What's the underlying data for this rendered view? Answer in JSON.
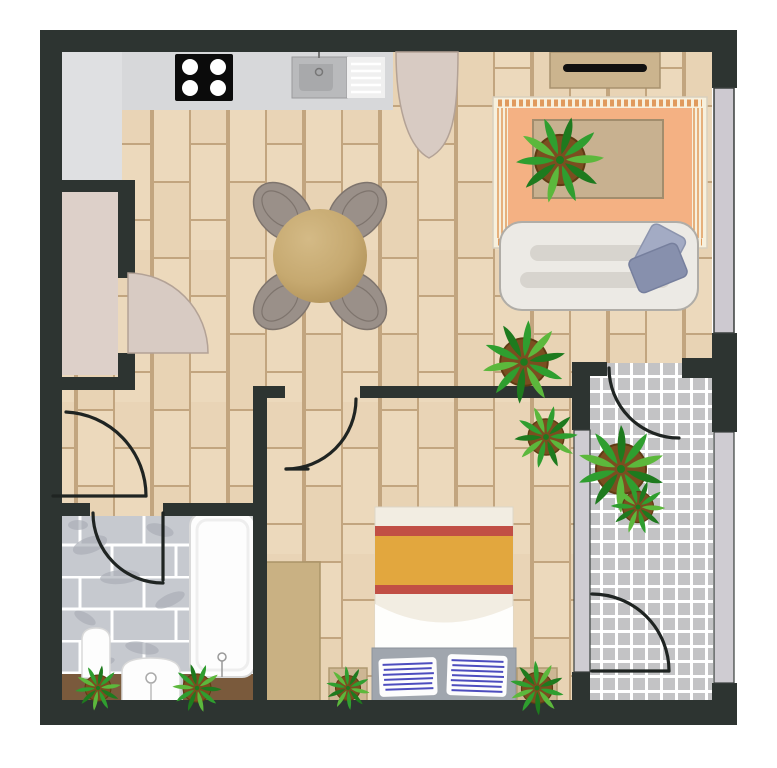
{
  "title": "Apartment floor plan (top-down view)",
  "colors": {
    "wall": "#2d3431",
    "doorLine": "#1f2422",
    "woodBase": "#ecd9bc",
    "woodAlt": "#e2ccab",
    "woodLine": "#c2a57f",
    "counterStrip": "#d7d8da",
    "kitchenFloor": "#dfe0e2",
    "nookFloor": "#ddd0c9",
    "doorFill": "#d8cbc3",
    "doorEdge": "#b3a296",
    "stove": "#0b0b0b",
    "burner": "#ffffff",
    "sinkOuter": "#b9babc",
    "sinkInner": "#a8a9ab",
    "drainPanel": "#f0f0f0",
    "consoleFill": "#cbb48e",
    "consoleEdge": "#a8926e",
    "tvBlack": "#101010",
    "rugBase": "#f7f0dd",
    "rugField": "#f4b183",
    "rugAccent": "#e09a5d",
    "coffeeTable": "#c8b190",
    "coffeeEdge": "#a28d6d",
    "sofaFill": "#eceae5",
    "sofaEdge": "#b0ada7",
    "sofaShadow": "#d7d4ce",
    "pillowLight": "#a3abc4",
    "pillowDark": "#8790ad",
    "diningTable": "#c8ab74",
    "chairFill": "#9a9089",
    "chairEdge": "#7e746d",
    "potBrown": "#7b4e20",
    "leafDark": "#1e7a1e",
    "leafMid": "#2f9e2f",
    "leafLight": "#5cb83c",
    "bathFloor": "#c6c9cf",
    "bathMarble": "#a9adb6",
    "fixtureFill": "#fdfdfd",
    "fixtureEdge": "#d9d9d9",
    "planterBrown": "#7a5a3c",
    "planterTan": "#cdb694",
    "planterTanEdge": "#b09a72",
    "bedSheet": "#f2ede2",
    "bedRed": "#c14f45",
    "bedGold": "#e2a73e",
    "headboard": "#a0a6ae",
    "bedPillowLine": "#3a3ab8",
    "wardrobe": "#c9b183",
    "wardrobeEdge": "#ab9468",
    "balconyTile": "#c3c3c5",
    "railing": "#cfccd2",
    "windowFill": "#cdc9d0"
  },
  "scene": {
    "rooms": [
      {
        "name": "kitchen",
        "floor": "light-gray"
      },
      {
        "name": "living-room",
        "floor": "wood-planks"
      },
      {
        "name": "dining-area",
        "floor": "wood-planks"
      },
      {
        "name": "entry-closet-nook",
        "floor": "beige"
      },
      {
        "name": "hallway",
        "floor": "wood-planks"
      },
      {
        "name": "bathroom",
        "floor": "gray-marble-brick-tile"
      },
      {
        "name": "bedroom",
        "floor": "wood-planks"
      },
      {
        "name": "balcony",
        "floor": "gray-grid-tile"
      }
    ],
    "furniture": [
      "stove-cooktop",
      "kitchen-sink",
      "drainboard",
      "dining-table",
      "dining-chairs",
      "tv-console",
      "tv",
      "area-rug",
      "coffee-table",
      "sofa",
      "throw-pillows",
      "wardrobe",
      "bed",
      "bed-pillows",
      "bedside-planters",
      "bathtub",
      "toilet",
      "wash-basin",
      "bathroom-planters"
    ],
    "plant_count": 9,
    "door_swing_count": 7,
    "window_count": 1
  }
}
